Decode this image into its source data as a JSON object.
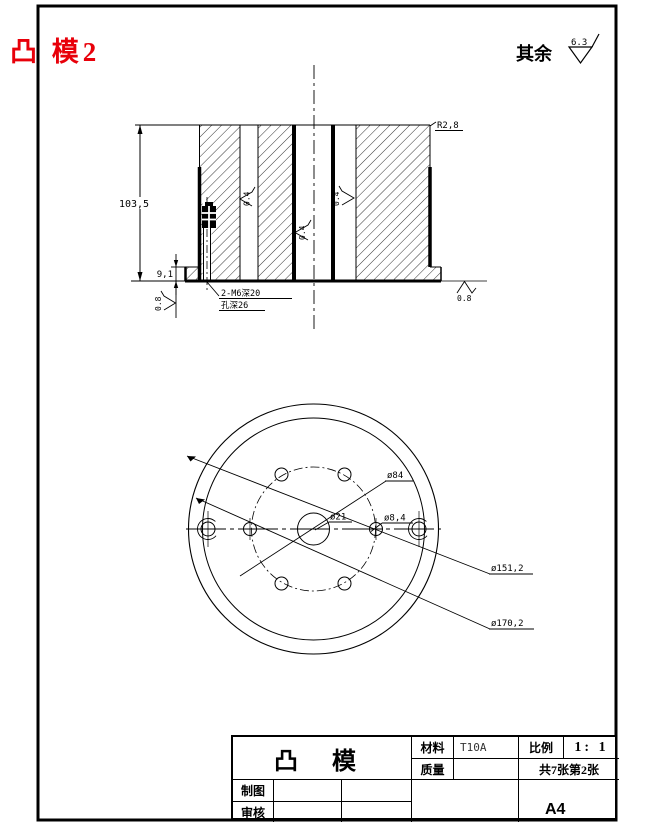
{
  "drawing": {
    "title": "凸 模2",
    "surface_finish_prefix": "其余",
    "surface_finish_value": "6.3"
  },
  "section_view": {
    "height_dim": "103,5",
    "step_dim": "9,1",
    "fillet": "R2,8",
    "thread_callout_line1": "2-M6深20",
    "thread_callout_line2": "孔深26",
    "roughness_bore_left": "0.4",
    "roughness_bore_center": "0.4",
    "roughness_bore_right": "0.4",
    "roughness_base_left": "0.8",
    "roughness_base_right": "0.8"
  },
  "bottom_view": {
    "bolt_circle_dia": "ø84",
    "center_hole_dia": "ø21",
    "bolt_hole_dia": "ø8,4",
    "step_dia": "ø151,2",
    "outer_dia": "ø170,2"
  },
  "title_block": {
    "part_name": "凸 模",
    "material_label": "材料",
    "material_value": "T10A",
    "scale_label": "比例",
    "scale_value": "1: 1",
    "mass_label": "质量",
    "mass_value": "",
    "sheet_info": "共7张第2张",
    "drawn_by_label": "制图",
    "checked_by_label": "审核",
    "paper_size": "A4"
  }
}
